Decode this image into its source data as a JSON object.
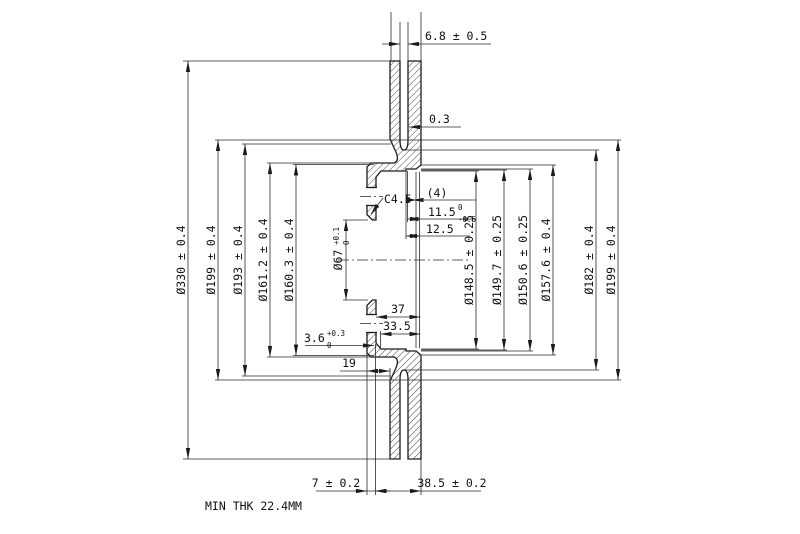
{
  "dims": {
    "od330": "Ø330 ± 0.4",
    "d199_left": "Ø199 ± 0.4",
    "d193": "Ø193 ± 0.4",
    "d161_2": "Ø161.2 ± 0.4",
    "d160_3": "Ø160.3 ± 0.4",
    "d148_5": "Ø148.5 ± 0.25",
    "d149_7": "Ø149.7 ± 0.25",
    "d150_6": "Ø150.6 ± 0.25",
    "d157_6": "Ø157.6 ± 0.4",
    "d182": "Ø182 ± 0.4",
    "d199_right": "Ø199 ± 0.4",
    "vane_gap": "6.8 ± 0.5",
    "offset_0_3": "0.3",
    "chamfer": "C4.5",
    "ref_count": "(4)",
    "depth11_5": {
      "value": "11.5",
      "tol_upper": "0",
      "tol_lower": "-0.5"
    },
    "depth12_5": "12.5",
    "bore": {
      "value": "Ø67",
      "tol_upper": "+0.1",
      "tol_lower": "0"
    },
    "depth37": "37",
    "depth33_5": "33.5",
    "step3_6": {
      "value": "3.6",
      "tol_upper": "+0.3",
      "tol_lower": "0"
    },
    "offset19": "19",
    "flange_thk": "7 ± 0.2",
    "overall_height": "38.5 ± 0.2",
    "note_min_thk": "MIN THK 22.4MM"
  }
}
